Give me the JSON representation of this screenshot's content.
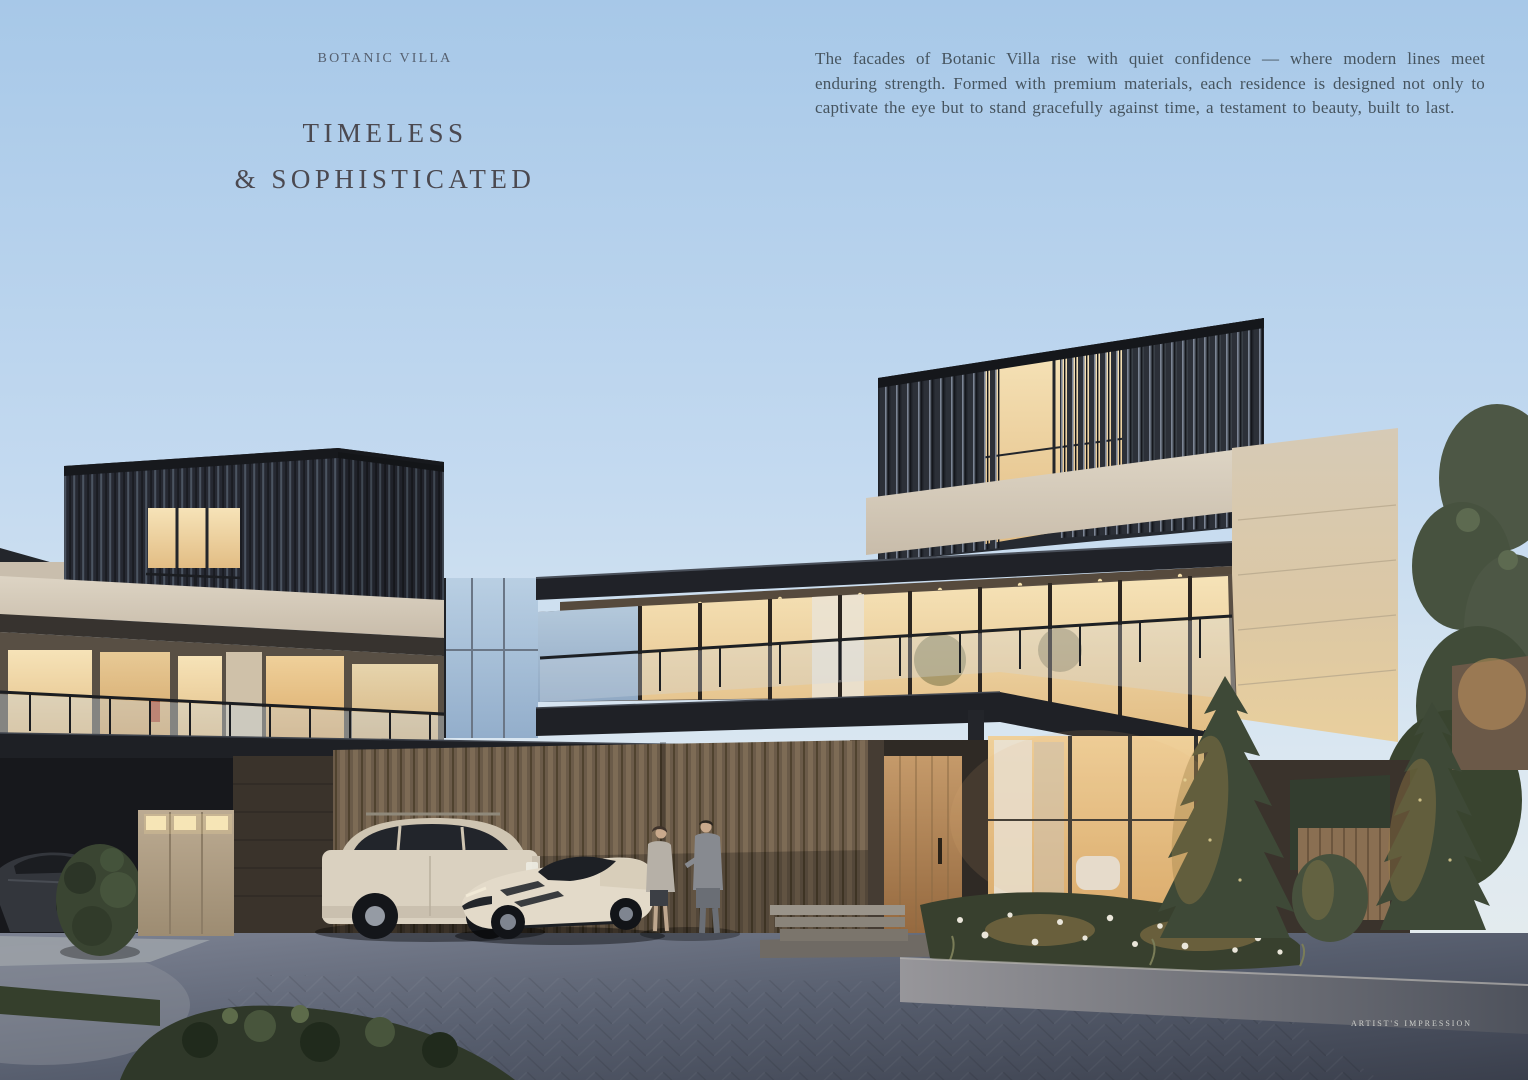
{
  "header": {
    "eyebrow": "BOTANIC VILLA",
    "title_line_1": "TIMELESS",
    "title_line_2": "& SOPHISTICATED"
  },
  "intro": {
    "body": "The facades of Botanic Villa rise with quiet confidence — where modern lines meet enduring strength. Formed with premium materials, each residence is designed not only to captivate the eye but to stand gracefully against time, a testament to beauty, built to last."
  },
  "footer": {
    "credit": "ARTIST'S IMPRESSION"
  },
  "colors": {
    "sky_top": "#a7c8e8",
    "sky_horizon": "#eaeeec",
    "eyebrow_text": "#566070",
    "title_text": "#4b4950",
    "body_text": "#46545f",
    "credit_text": "#d6d7d3",
    "facade_stone": "#d5cab7",
    "facade_dark_louvre": "#262a31",
    "warm_window_glow": "#f0d9a8",
    "timber_door": "#b98d5a",
    "driveway": "#575e6e",
    "foliage": "#3e4937"
  },
  "scene": {
    "description": "Dusk architectural rendering of two modern multi-storey villas with dark louvred upper volumes, stone facades, cantilevered roofs and warm-lit interiors; a cream luxury SUV and a cream sports car parked beside a dark sedan; a couple talking by the cars; uplit conifer trees, landscaped flower beds, timber entrance door and brick-paved driveway.",
    "time_of_day": "dusk",
    "elements": [
      "left villa",
      "right villa",
      "timber entrance door",
      "luxury SUV",
      "sports car",
      "dark sedan",
      "couple talking",
      "conifer trees",
      "flower bed",
      "brick driveway",
      "mailbox cabinets",
      "glass balustrades"
    ]
  }
}
